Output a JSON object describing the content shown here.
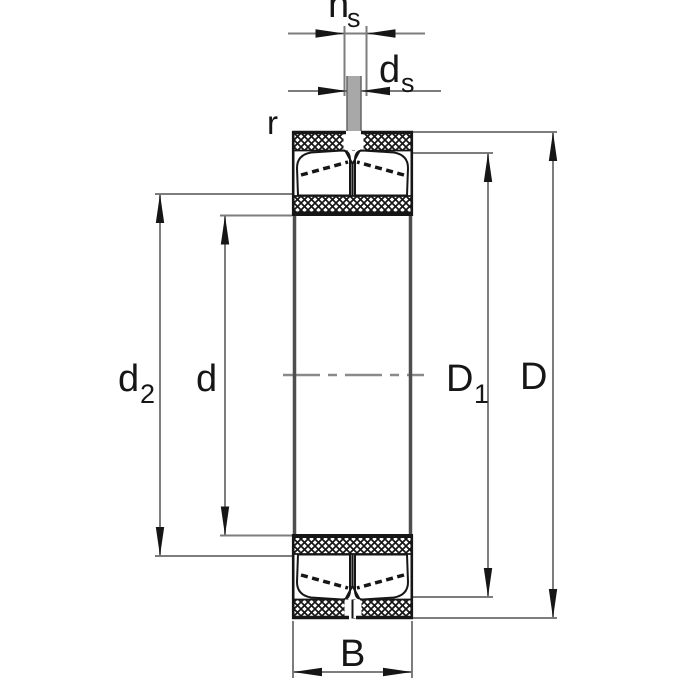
{
  "drawing": {
    "kind": "bearing-section-dimension-drawing",
    "colors": {
      "outline_black": "#161616",
      "dimension_gray": "#7d7d7d",
      "centerline_gray": "#8a8a8a",
      "pin_gray": "#a8a8a8",
      "middle_side_gray": "#4e4e4e",
      "background": "#ffffff"
    },
    "dimensions": {
      "ns": {
        "main": "n",
        "sub": "s"
      },
      "ds": {
        "main": "d",
        "sub": "s"
      },
      "r": {
        "main": "r"
      },
      "d2": {
        "main": "d",
        "sub": "2"
      },
      "d": {
        "main": "d"
      },
      "D1": {
        "main": "D",
        "sub": "1"
      },
      "D": {
        "main": "D"
      },
      "B": {
        "main": "B"
      }
    }
  }
}
